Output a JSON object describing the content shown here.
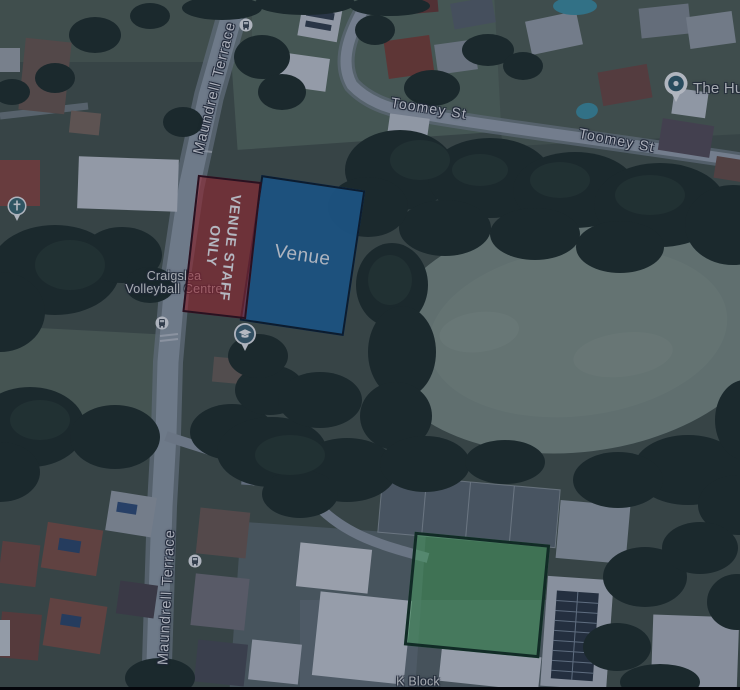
{
  "map_labels": {
    "maundrell_top": "Maundrell Terrace",
    "maundrell_bottom": "Maundrell Terrace",
    "toomey_left": "Toomey St",
    "toomey_right": "Toomey St",
    "craigslea_line1": "Craigslea",
    "craigslea_line2": "Volleyball Centre",
    "the_hub": "The Hu",
    "k_block": "K Block"
  },
  "overlays": {
    "staff_zone": {
      "line1": "VENUE STAFF",
      "line2": "ONLY",
      "fill": "rgba(198,44,48,0.58)",
      "border_color": "#33101a",
      "base_color": "#c62c30"
    },
    "venue_zone": {
      "label": "Venue",
      "fill": "rgba(33,105,158,0.94)",
      "border_color": "#0c1f2e",
      "base_color": "#21699e"
    },
    "green_zone": {
      "fill": "rgba(92,196,112,0.58)",
      "border_color": "#123421",
      "base_color": "#5cc470"
    }
  },
  "icons": {
    "bus_stop": "bus-stop-icon",
    "church": "church-pin-icon",
    "school": "school-pin-icon",
    "place": "place-pin-icon"
  }
}
